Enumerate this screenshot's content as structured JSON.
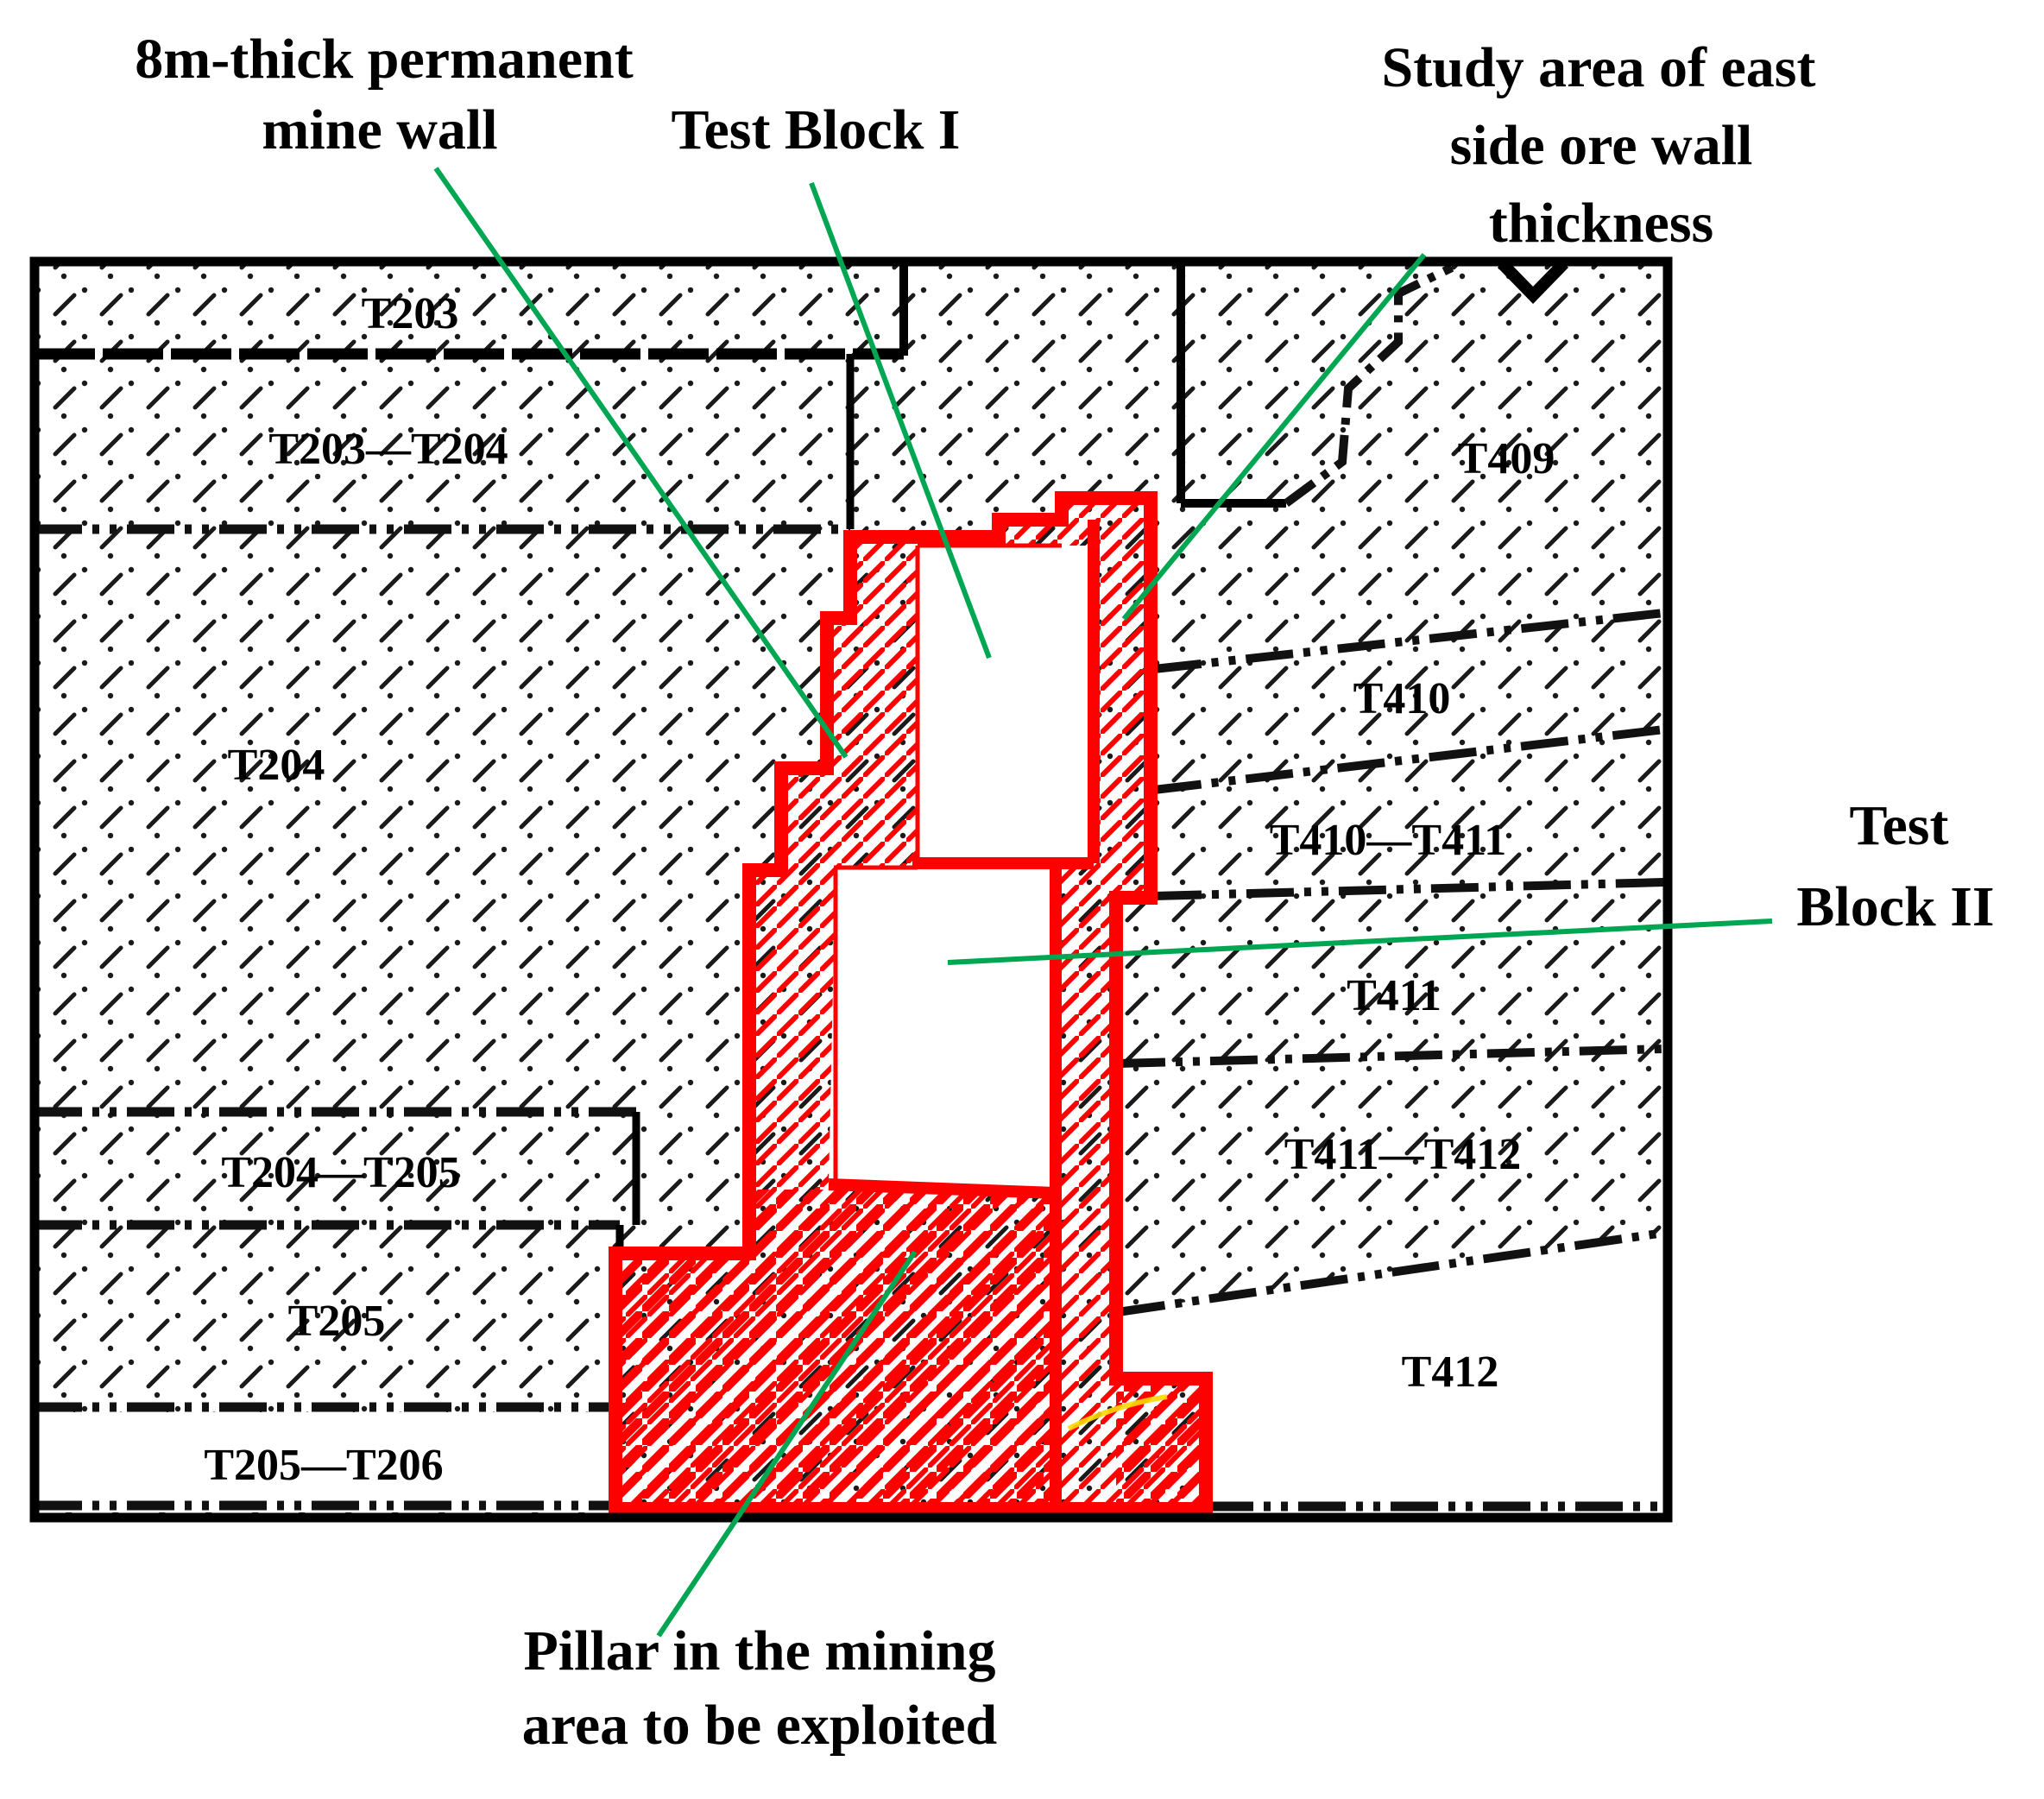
{
  "figure": {
    "title": "Mine plan schematic with test blocks and pillar area",
    "colors": {
      "pillar_outline": "#ff0000",
      "leader_line": "#00a651",
      "boundary_line": "#000000",
      "hatch": "#000000",
      "background": "#ffffff",
      "marker_curve": "#ffd800"
    },
    "annotations": {
      "permanent_wall": {
        "line1": "8m-thick permanent",
        "line2": "mine wall"
      },
      "test_block_1": "Test Block I",
      "study_area": {
        "line1": "Study area of east",
        "line2": "side ore wall",
        "line3": "thickness"
      },
      "test_block_2": {
        "line1": "Test",
        "line2": "Block II"
      },
      "pillar": {
        "line1": "Pillar in the mining",
        "line2": "area to be exploited"
      }
    },
    "regions": {
      "left": [
        "T203",
        "T203—T204",
        "T204",
        "T204—T205",
        "T205",
        "T205—T206"
      ],
      "right": [
        "T409",
        "T410",
        "T410—T411",
        "T411",
        "T411—T412",
        "T412"
      ]
    }
  }
}
